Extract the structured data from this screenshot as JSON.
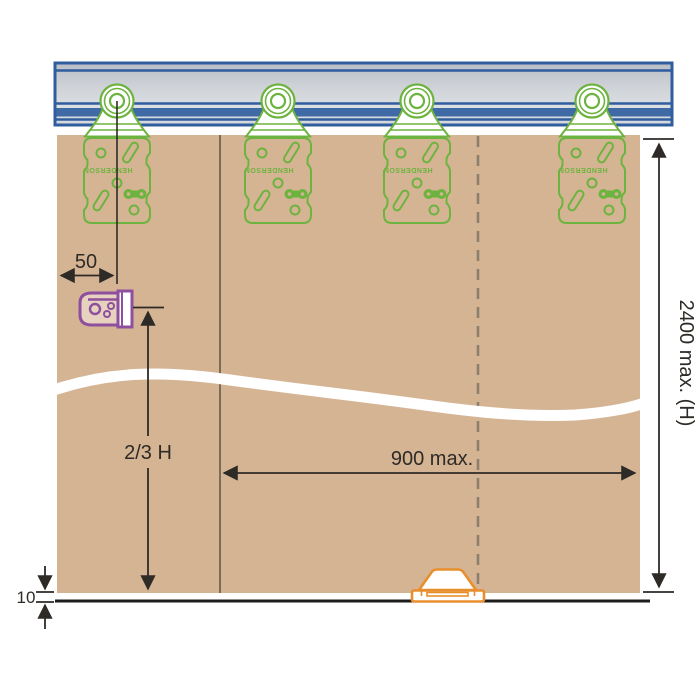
{
  "title": "Sliding door track and hanger installation diagram",
  "colors": {
    "track_blue": "#2f5d9e",
    "track_gray_light": "#dfe2e6",
    "track_gray_dark": "#bfc4cb",
    "hanger_green": "#6db33f",
    "door_tan": "#d5b494",
    "bracket_purple": "#8e4f9e",
    "guide_orange": "#e88f2d",
    "dimension_dark": "#2e2a26",
    "dashed_gray": "#8d7f6d",
    "joint_line": "#504a40",
    "floor_black": "#1d1d1d"
  },
  "labels": {
    "hanger_offset": "50",
    "bracket_height": "2/3 H",
    "panel_width": "900 max.",
    "door_height": "2400 max. (H)",
    "floor_gap": "10"
  },
  "hangers": {
    "brand": "HENDERSON",
    "count": 4
  }
}
